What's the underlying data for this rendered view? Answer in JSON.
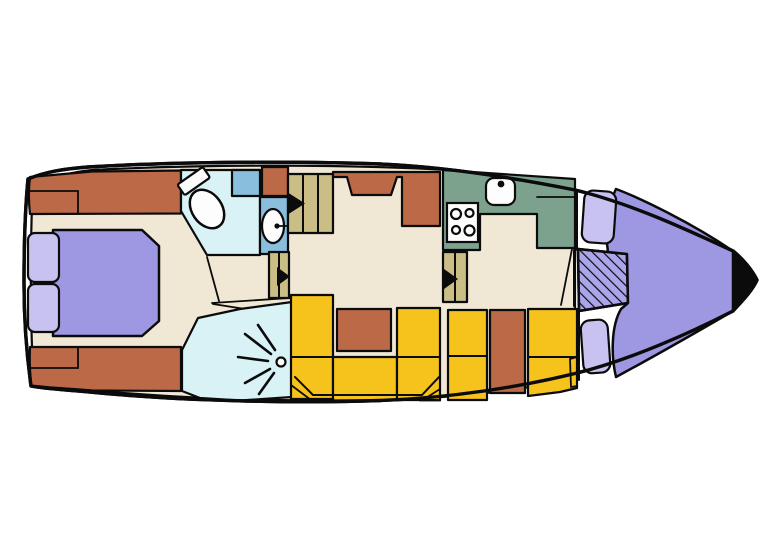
{
  "document": {
    "type": "boat-deck-floor-plan",
    "orientation": {
      "bow": "right",
      "stern": "left"
    }
  },
  "colors": {
    "outline": "#0b0b0b",
    "hull": "#ffffff",
    "floor": "#f1e7d5",
    "terracotta": "#bb6946",
    "yellow": "#f5c31b",
    "tan": "#cbbd86",
    "green": "#7ca28e",
    "cyan": "#d8f2f6",
    "blue": "#89bedc",
    "berth": "#9e98e2",
    "pillow": "#c7c2ef",
    "hatch": "#aba5e9",
    "white": "#fdfdfd"
  },
  "features": {
    "aft_cabin": [
      "double-bed",
      "pillow-port",
      "pillow-starboard",
      "storage-step-top",
      "storage-step-bottom"
    ],
    "wet_rooms": [
      "toilet-room",
      "toilet",
      "washbasin",
      "vanity-shelf",
      "shower-room",
      "shower-head"
    ],
    "midship": [
      "companionway-steps-aft",
      "corridor-steps",
      "salon-settee",
      "sideboard"
    ],
    "galley": [
      "counter",
      "sink",
      "stove-4-burner",
      "companionway-steps-bow"
    ],
    "dinette": [
      "u-shaped-bench",
      "table",
      "side-bench",
      "side-table"
    ],
    "bow_cabin": [
      "v-berth",
      "pillow-top",
      "pillow-bottom",
      "hatched-locker",
      "bow-tip"
    ]
  }
}
